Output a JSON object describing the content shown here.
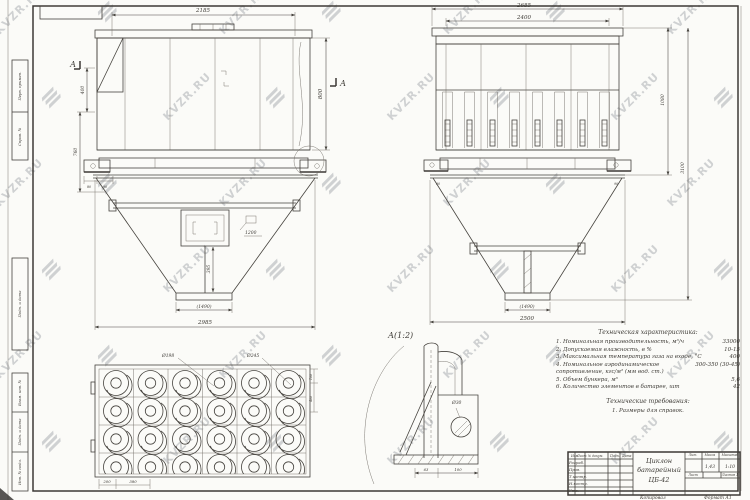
{
  "watermark": {
    "text": "KVZR.RU",
    "color": "#8e939a",
    "opacity": 0.4,
    "rows": 6,
    "cols": 7,
    "dx": 112,
    "dy": 86,
    "x0": -12,
    "y0": 4,
    "stagger": 56
  },
  "front_view": {
    "section_label": "А",
    "dims": {
      "top": "2185",
      "right": "800",
      "left_upper": "400",
      "left_lower": "760",
      "foot_a": "80",
      "foot_b": "90",
      "door": "1200",
      "drop": "395",
      "flange": "(1490)",
      "bottom": "2985"
    }
  },
  "side_view": {
    "dims": {
      "top_outer": "2685",
      "top_inner": "2400",
      "right_upper": "1080",
      "right_total": "3100",
      "flange": "(1490)",
      "bottom": "2500",
      "foot_left": "90",
      "foot_right": "90"
    }
  },
  "plan_view": {
    "grid": {
      "rows": 4,
      "cols": 6
    },
    "dims": {
      "inner_dia": "Ø198",
      "outer_dia": "Ø245",
      "bottom_a": "200",
      "bottom_b": "380",
      "right_a": "100",
      "right_b": "400"
    }
  },
  "detail_view": {
    "label": "А(1:2)",
    "hole_dia": "Ø30",
    "dim_a": "63",
    "dim_b": "100"
  },
  "notes": {
    "title": "Техническая характеристика:",
    "items": [
      {
        "t": "1. Номинальная производительность, м³/ч",
        "v": "33000"
      },
      {
        "t": "2. Допускаемая влажность, в %",
        "v": "10-15"
      },
      {
        "t": "3. Максимальная температура газа на входе, °С",
        "v": "400"
      },
      {
        "t": "4. Номинальное аэродинамическое сопротивление, кгс/м² (мм вод. ст.)",
        "v": "300-350 (30-45)"
      },
      {
        "t": "5. Объем бункера, м³",
        "v": "5,6"
      },
      {
        "t": "6. Количество элементов в батарее, шт",
        "v": "42"
      }
    ],
    "title2": "Технические требования:",
    "items2": [
      "1. Размеры для справок."
    ]
  },
  "title_block": {
    "name_1": "Циклон",
    "name_2": "батарейный",
    "name_3": "ЦБ-42",
    "col_headers": [
      "Изм.",
      "Лист",
      "№ докум.",
      "Подп.",
      "Дата"
    ],
    "rows": [
      "Разраб.",
      "Пров.",
      "Т.контр.",
      "Н.контр.",
      "Утв."
    ],
    "lit_label": "Лит.",
    "mass_label": "Масса",
    "scale_label": "Масштаб",
    "mass": "1,43",
    "scale": "1:10",
    "sheet_label": "Лист",
    "sheets_label": "Листов 1",
    "footer_copy": "Копировал",
    "footer_format": "Формат А1"
  },
  "margin_stamps": [
    "Перв. примен.",
    "Справ. №",
    "Подп. и дата",
    "Взам. инв. №",
    "Подп. и дата",
    "Инв. № подл."
  ]
}
